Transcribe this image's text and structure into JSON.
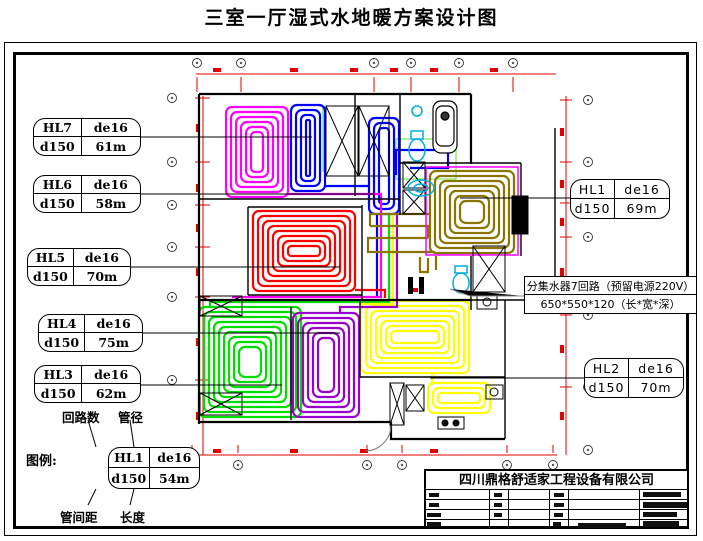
{
  "title": "三室一厅湿式水地暖方案设计图",
  "loop_labels": [
    {
      "id": "HL7",
      "pipe": "de16",
      "spacing": "d150",
      "length": "61m"
    },
    {
      "id": "HL6",
      "pipe": "de16",
      "spacing": "d150",
      "length": "58m"
    },
    {
      "id": "HL5",
      "pipe": "de16",
      "spacing": "d150",
      "length": "70m"
    },
    {
      "id": "HL4",
      "pipe": "de16",
      "spacing": "d150",
      "length": "75m"
    },
    {
      "id": "HL3",
      "pipe": "de16",
      "spacing": "d150",
      "length": "62m"
    },
    {
      "id": "HL1",
      "pipe": "de16",
      "spacing": "d150",
      "length": "69m"
    },
    {
      "id": "HL2",
      "pipe": "de16",
      "spacing": "d150",
      "length": "70m"
    }
  ],
  "legend": {
    "caption": "图例:",
    "label_top_left": "回路数",
    "label_top_right": "管径",
    "label_bottom_left": "管间距",
    "label_bottom_right": "长度",
    "sample": {
      "id": "HL1",
      "pipe": "de16",
      "spacing": "d150",
      "length": "54m"
    }
  },
  "manifold_note": {
    "line1": "分集水器7回路（预留电源220V）",
    "line2": "650*550*120（长*宽*深）"
  },
  "title_block": {
    "company": "四川鼎格舒适家工程设备有限公司"
  },
  "colors": {
    "hl7": "#FF00FF",
    "hl6": "#0000FF",
    "hl5": "#FF0000",
    "hl4": "#9900CC",
    "hl3": "#00DD00",
    "hl2": "#FFFF00",
    "hl1": "#8B7500",
    "fixture": "#00AEDD",
    "dim": "#E00000",
    "wall": "#000000"
  },
  "plan": {
    "coils": [
      {
        "name": "hl7-coil",
        "color": "#FF00FF",
        "x": 226,
        "y": 107,
        "w": 62,
        "h": 90,
        "rings": 6,
        "gap": 5
      },
      {
        "name": "hl6-coil",
        "color": "#0000FF",
        "x": 291,
        "y": 105,
        "w": 34,
        "h": 86,
        "rings": 4,
        "gap": 5
      },
      {
        "name": "hl6-coil-hall",
        "color": "#0000FF",
        "x": 369,
        "y": 118,
        "w": 30,
        "h": 96,
        "rings": 3,
        "gap": 5
      },
      {
        "name": "hl1-coil",
        "color": "#8B7500",
        "x": 430,
        "y": 171,
        "w": 84,
        "h": 82,
        "rings": 7,
        "gap": 5
      },
      {
        "name": "hl5-coil",
        "color": "#FF0000",
        "x": 253,
        "y": 211,
        "w": 102,
        "h": 80,
        "rings": 8,
        "gap": 5
      },
      {
        "name": "hl3-coil",
        "color": "#00DD00",
        "x": 199,
        "y": 307,
        "w": 102,
        "h": 110,
        "rings": 9,
        "gap": 5
      },
      {
        "name": "hl4-coil",
        "color": "#9900CC",
        "x": 293,
        "y": 313,
        "w": 66,
        "h": 104,
        "rings": 6,
        "gap": 5
      },
      {
        "name": "hl2-coil",
        "color": "#FFFF00",
        "x": 361,
        "y": 301,
        "w": 108,
        "h": 72,
        "rings": 7,
        "gap": 5
      },
      {
        "name": "hl2-coil-kitchen",
        "color": "#FFFF00",
        "x": 428,
        "y": 383,
        "w": 62,
        "h": 30,
        "rings": 3,
        "gap": 5
      }
    ]
  }
}
